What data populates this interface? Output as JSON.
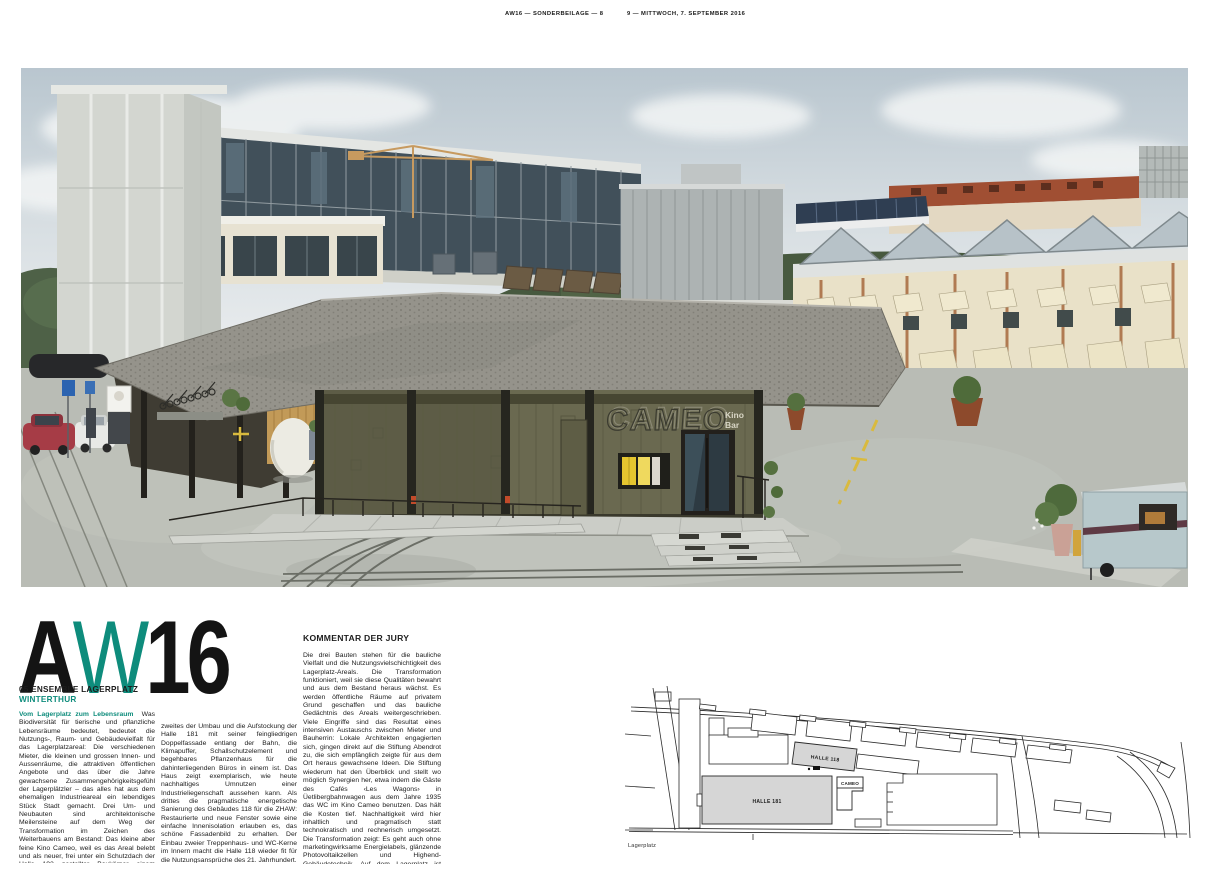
{
  "header": {
    "left": "AW16 — SONDERBEILAGE — 8",
    "right": "9 — MITTWOCH, 7. SEPTEMBER 2016"
  },
  "masthead": {
    "part_a": "A",
    "part_w": "W",
    "part_16": "16"
  },
  "article": {
    "number_title": "05 ENSEMBLE LAGERPLATZ",
    "city": "WINTERTHUR",
    "lead_in": "Vom Lagerplatz zum Lebensraum",
    "column1": "Was Biodiversität für tierische und pflanzliche Lebensräume bedeutet, bedeutet die Nutzungs-, Raum- und Gebäudevielfalt für das Lagerplatzareal: Die verschiedenen Mieter, die kleinen und grossen Innen- und Aussenräume, die attraktiven öffentlichen Angebote und das über die Jahre gewachsene Zusammengehörigkeitsgefühl der Lagerplätzler – das alles hat aus dem ehemaligen Industrieareal ein lebendiges Stück Stadt gemacht. Drei Um- und Neubauten sind architektonische Meilensteine auf dem Weg der Transformation im Zeichen des Weiterbauens am Bestand: Das kleine aber feine Kino Cameo, weil es das Areal belebt und als neuer, frei unter ein Schutzdach der Halle 192 gestellter Baukörper einem typischen Nebengebäude des Lagerplatzes wieder Sinn und wohl auch längeres Leben verleiht. Als",
    "column2": "zweites der Umbau und die Aufstockung der Halle 181 mit seiner feingliedrigen Doppelfassade entlang der Bahn, die Klimapuffer, Schallschutzelement und begehbares Pflanzenhaus für die dahinterliegenden Büros in einem ist. Das Haus zeigt exemplarisch, wie heute nachhaltiges Umnutzen einer Industrieliegenschaft aussehen kann. Als drittes die pragmatische energetische Sanierung des Gebäudes 118 für die ZHAW: Restaurierte und neue Fenster sowie eine einfache Innenisolation erlauben es, das schöne Fassadenbild zu erhalten. Der Einbau zweier Treppenhaus- und WC-Kerne im Innern macht die Halle 118 wieder fit für die Nutzungsansprüche des 21. Jahrhundert.",
    "jury_heading": "KOMMENTAR DER JURY",
    "jury_text": "Die drei Bauten stehen für die bauliche Vielfalt und die Nutzungsvielschichtigkeit des Lagerplatz-Areals. Die Transformation funktioniert, weil sie diese Qualitäten bewahrt und aus dem Bestand heraus wächst. Es werden öffentliche Räume auf privatem Grund geschaffen und das bauliche Gedächtnis des Areals weitergeschrieben. Viele Eingriffe sind das Resultat eines intensiven Austauschs zwischen Mieter und Bauherrin: Lokale Architekten engagierten sich, gingen direkt auf die Stiftung Abendrot zu, die sich empfänglich zeigte für aus dem Ort heraus gewachsene Ideen. Die Stiftung wiederum hat den Überblick und stellt wo möglich Synergien her, etwa indem die Gäste des Cafés ‹Les Wagons› in Üetlibergbahnwagen aus dem Jahre 1935 das WC im Kino Cameo benutzen. Das hält die Kosten tief. Nachhaltigkeit wird hier inhaltlich und pragmatisch statt technokratisch und rechnerisch umgesetzt. Die Transformation zeigt: Es geht auch ohne marketingwirksame Energielabels, glänzende Photovoltaikzellen und Highend-Gebäudetechnik. Auf dem Lagerplatz ist vielmehr gesellschaftlicher Tiefgang, schonender Umgang mit der Substanz und damit mit der grauen Energie das Ziel."
  },
  "photo": {
    "cameo_sign": "CAMEO",
    "kino_label": "Kino",
    "bar_label": "Bar"
  },
  "siteplan": {
    "halle_118": "HALLE 118",
    "halle_181": "HALLE 181",
    "cameo": "CAMEO",
    "caption": "Lagerplatz"
  },
  "colors": {
    "accent": "#0E8C7C",
    "roof_gray": "#95938b",
    "facade_olive": "#6a6950"
  }
}
